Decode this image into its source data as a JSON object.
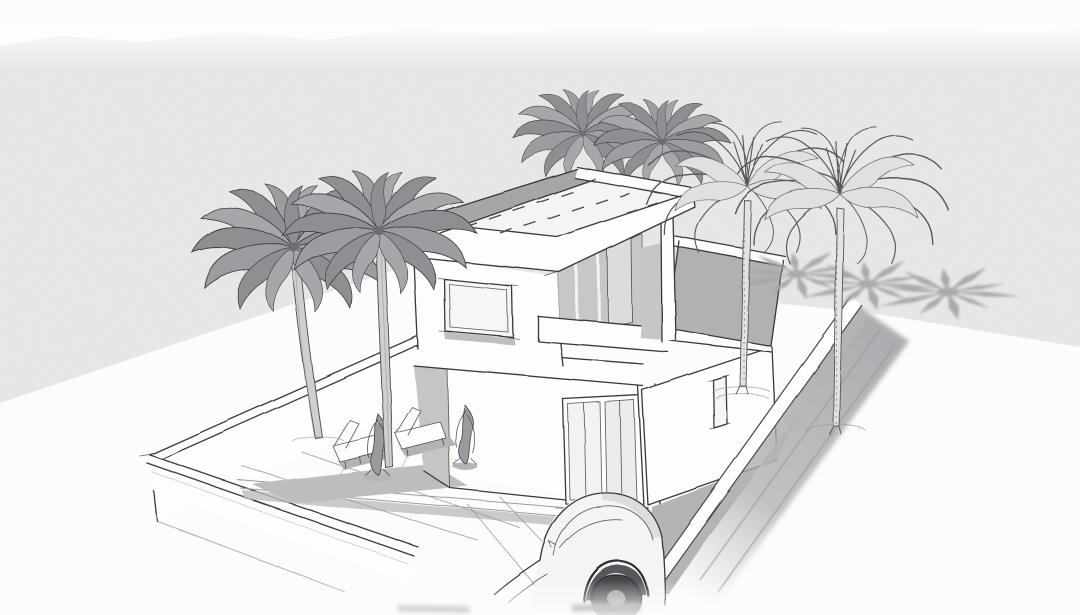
{
  "scene": {
    "title": "Architectural concept sketch of a modern two-storey villa with palm trees",
    "description": "Hand-drawn black-and-white architectural perspective sketch on light grey paper: a modern flat-roofed two-storey villa with an overhanging roof slab, roof-terrace parapet and a single-storey side wing, set inside a low walled plot. Two heavily shaded palms stand at the left wall, two palm crowns rise behind the roof, two line-drawn palms stand along the right wall, and three palm-frond shadows fall on the ground at the right. The courtyard holds two sun loungers and two shrubs; a loosely sketched car sits at the driveway, cropped and fading at the lower edge.",
    "medium": "pencil and ink line work with grey marker shading",
    "palette": {
      "paper_grey": "#e9e9e7",
      "page_white": "#fcfcfb",
      "line_ink": "#38383c",
      "shade_light": "#c5c5c7",
      "shade_mid": "#aeaeb1",
      "shade_dark": "#97979b",
      "wheel_dark": "#46464b"
    },
    "objects": {
      "house": {
        "label": "two-storey flat-roof villa with picture window, recessed glazed terrace, balcony parapet, sliding glass doors and single-storey wing with small window"
      },
      "palm_trees": {
        "count": 6,
        "label": "2 shaded palms left, 2 crowns behind the roof, 2 line-drawn palms right"
      },
      "palm_shadows": {
        "count": 3,
        "label": "starburst frond shadows on the ground, upper right"
      },
      "perimeter_wall": {
        "label": "low white boundary wall around the plot with cap band"
      },
      "sun_loungers": {
        "count": 2
      },
      "shrubs": {
        "count": 2
      },
      "car": {
        "count": 1,
        "label": "sketched car at the driveway opening, cropped by the bottom edge"
      }
    }
  }
}
